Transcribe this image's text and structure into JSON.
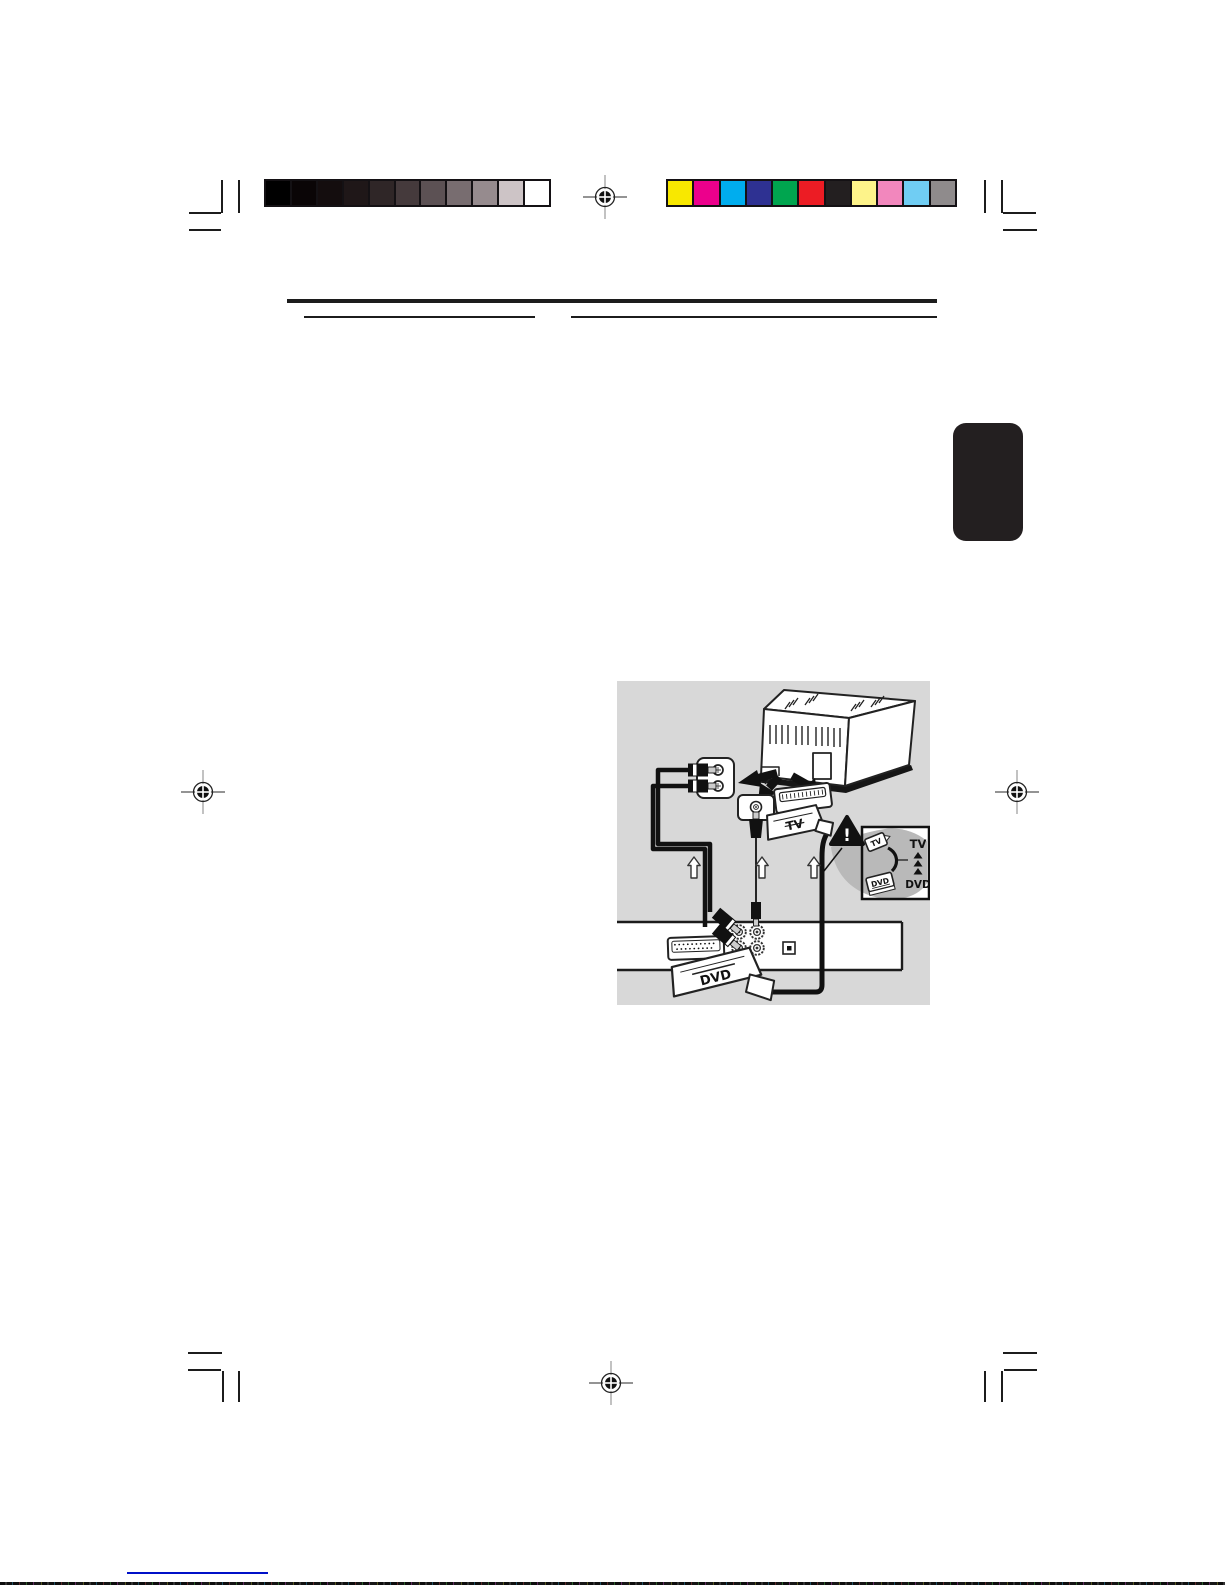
{
  "calibration": {
    "grayscale": [
      "#000000",
      "#0a0506",
      "#140d0e",
      "#1f1718",
      "#2f2627",
      "#453a3c",
      "#5c5154",
      "#786d70",
      "#968b8e",
      "#cdc4c6",
      "#ffffff"
    ],
    "colors": [
      "#f8e800",
      "#ec008c",
      "#00adee",
      "#2e3192",
      "#00a54f",
      "#ec1c24",
      "#231f20",
      "#fdf38a",
      "#f287bd",
      "#70cdf3",
      "#8f8b8c"
    ]
  },
  "diagram": {
    "tv_plug_label": "TV",
    "dvd_plug_label": "DVD",
    "warning_mark": "!",
    "inset": {
      "tv_plug_label": "TV",
      "dvd_plug_label": "DVD",
      "tv_text": "TV",
      "dvd_text": "DVD"
    }
  },
  "colors": {
    "tab": "#231f20",
    "diagram_panel": "#d8d8d8",
    "blue_line": "#0010c8",
    "ink": "#1c1c1c"
  }
}
